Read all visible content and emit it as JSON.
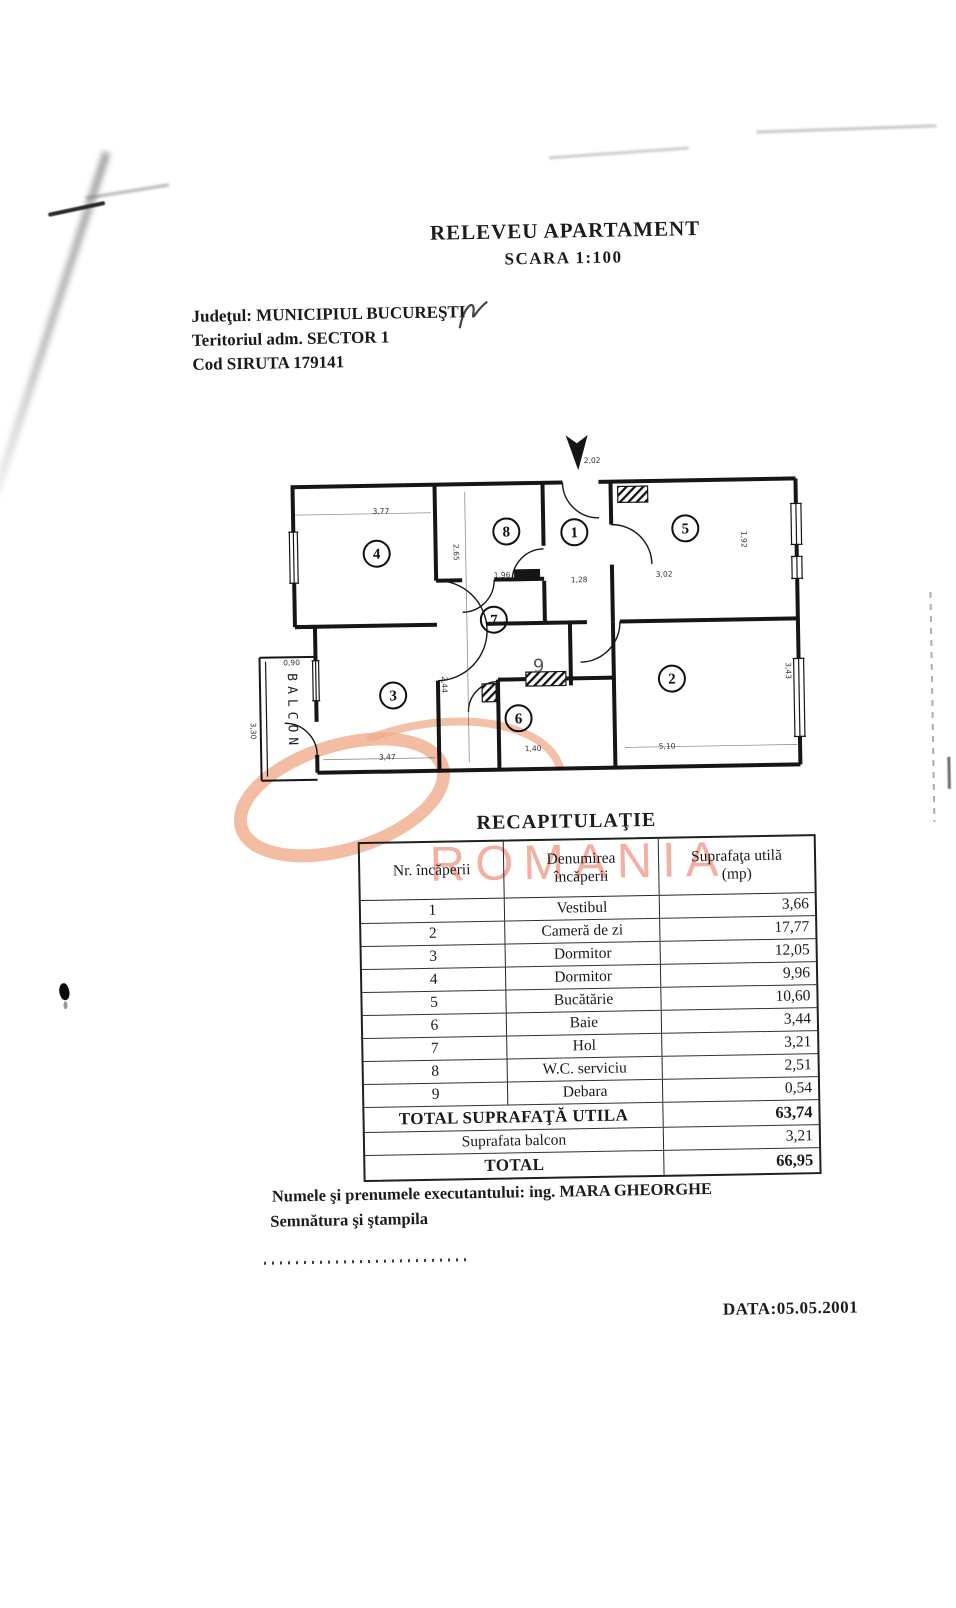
{
  "page": {
    "title": "RELEVEU APARTAMENT",
    "scale_line": "SCARA  1:100",
    "county_line": "Judeţul: MUNICIPIUL BUCUREŞTI",
    "territory_line": "Teritoriul adm. SECTOR 1",
    "siruta_line": "Cod SIRUTA 179141",
    "executor_line": "Numele şi prenumele executantului: ing. MARA GHEORGHE",
    "signature_line": "Semnătura şi ştampila",
    "date_line": "DATA:05.05.2001"
  },
  "watermark": {
    "text": "ROMANIA",
    "color": "#ef9a7d"
  },
  "plan": {
    "balcony_label": "BALCON",
    "rooms": [
      {
        "n": "1",
        "x": 341,
        "y": 102
      },
      {
        "n": "2",
        "x": 436,
        "y": 250
      },
      {
        "n": "3",
        "x": 157,
        "y": 262
      },
      {
        "n": "4",
        "x": 143,
        "y": 120
      },
      {
        "n": "5",
        "x": 452,
        "y": 100
      },
      {
        "n": "6",
        "x": 282,
        "y": 287
      },
      {
        "n": "7",
        "x": 259,
        "y": 188
      },
      {
        "n": "8",
        "x": 273,
        "y": 100
      },
      {
        "n": "9",
        "x": 303,
        "y": 236,
        "c": false
      }
    ],
    "dimensions": [
      {
        "t": "3,77",
        "x": 148,
        "y": 80
      },
      {
        "t": "2,02",
        "x": 360,
        "y": 33
      },
      {
        "t": "1,96",
        "x": 268,
        "y": 146
      },
      {
        "t": "1,28",
        "x": 345,
        "y": 152
      },
      {
        "t": "3,02",
        "x": 430,
        "y": 148
      },
      {
        "t": "5,10",
        "x": 430,
        "y": 320
      },
      {
        "t": "3,47",
        "x": 150,
        "y": 326
      },
      {
        "t": "1,40",
        "x": 296,
        "y": 320
      },
      {
        "t": "0,90",
        "x": 56,
        "y": 230
      },
      {
        "t": "2,44",
        "x": 206,
        "y": 252,
        "r": 90
      },
      {
        "t": "2,65",
        "x": 220,
        "y": 120,
        "r": 90
      },
      {
        "t": "3,43",
        "x": 550,
        "y": 244,
        "r": 90
      },
      {
        "t": "1,92",
        "x": 508,
        "y": 112,
        "r": 90
      },
      {
        "t": "3,30",
        "x": 14,
        "y": 295,
        "r": 90
      }
    ]
  },
  "table": {
    "title": "RECAPITULAŢIE",
    "header": {
      "col1": "Nr. încăperii",
      "col2_line1": "Denumirea",
      "col2_line2": "încăperii",
      "col3_line1": "Suprafaţa utilă",
      "col3_line2": "(mp)"
    },
    "rows": [
      {
        "nr": "1",
        "name": "Vestibul",
        "area": "3,66"
      },
      {
        "nr": "2",
        "name": "Cameră de zi",
        "area": "17,77"
      },
      {
        "nr": "3",
        "name": "Dormitor",
        "area": "12,05"
      },
      {
        "nr": "4",
        "name": "Dormitor",
        "area": "9,96"
      },
      {
        "nr": "5",
        "name": "Bucătărie",
        "area": "10,60"
      },
      {
        "nr": "6",
        "name": "Baie",
        "area": "3,44"
      },
      {
        "nr": "7",
        "name": "Hol",
        "area": "3,21"
      },
      {
        "nr": "8",
        "name": "W.C. serviciu",
        "area": "2,51"
      },
      {
        "nr": "9",
        "name": "Debara",
        "area": "0,54"
      }
    ],
    "totals": {
      "util_label": "TOTAL SUPRAFAŢĂ UTILA",
      "util_value": "63,74",
      "balcony_label": "Suprafata balcon",
      "balcony_value": "3,21",
      "total_label": "TOTAL",
      "total_value": "66,95"
    }
  }
}
